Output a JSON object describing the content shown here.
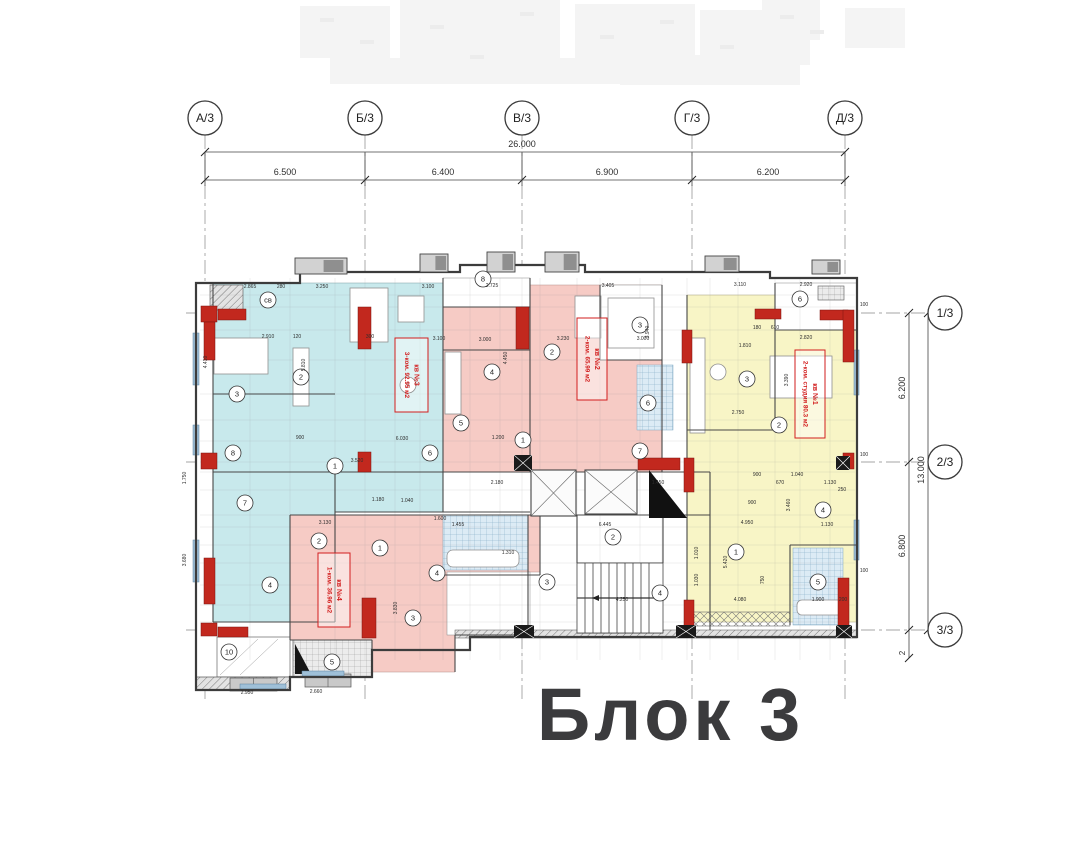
{
  "title": "Блок 3",
  "palette": {
    "cyan": "#c8e9ec",
    "pink": "#f6cbc5",
    "yellow": "#f8f5c6",
    "red_col": "#c2281e",
    "black_col": "#1a1a1a",
    "wall": "#3c3c3c",
    "dim_text": "#2e2e2e",
    "tile_blue": "#dcebf5",
    "tile_line": "#7fa8c4",
    "gray_fill": "#c9c9c9",
    "label_red": "#d21e1e",
    "title_color": "#3b3b3d",
    "window": "#9fc0d8",
    "ghost": "#f1f1f1"
  },
  "axes_top": [
    {
      "label": "А/3",
      "x": 205
    },
    {
      "label": "Б/3",
      "x": 365
    },
    {
      "label": "В/3",
      "x": 522
    },
    {
      "label": "Г/3",
      "x": 692
    },
    {
      "label": "Д/3",
      "x": 845
    }
  ],
  "axes_right": [
    {
      "label": "1/3",
      "y": 313
    },
    {
      "label": "2/3",
      "y": 462
    },
    {
      "label": "3/3",
      "y": 630
    }
  ],
  "dim_top": {
    "total": {
      "text": "26.000",
      "x": 522,
      "y": 147
    },
    "segments_y": 175,
    "segments": [
      {
        "text": "6.500",
        "x": 285
      },
      {
        "text": "6.400",
        "x": 443
      },
      {
        "text": "6.900",
        "x": 607
      },
      {
        "text": "6.200",
        "x": 768
      }
    ]
  },
  "dim_right": {
    "segments": [
      {
        "text": "6.200",
        "x": 905,
        "y": 388
      },
      {
        "text": "6.800",
        "x": 905,
        "y": 546
      }
    ],
    "total": {
      "text": "13.000",
      "x": 924,
      "y": 470
    },
    "extra": {
      "text": "2",
      "x": 905,
      "y": 653
    }
  },
  "apartments": [
    {
      "id": "apt-1",
      "lines": [
        "кв №1",
        "2-ком. студия 80.3 м2"
      ],
      "box": [
        795,
        350,
        30,
        88
      ]
    },
    {
      "id": "apt-2",
      "lines": [
        "кв №2",
        "2-ком. 65.99 м2"
      ],
      "box": [
        577,
        318,
        30,
        82
      ]
    },
    {
      "id": "apt-3",
      "lines": [
        "кв №3",
        "3-ком. 92.95 м2"
      ],
      "box": [
        395,
        338,
        33,
        74
      ]
    },
    {
      "id": "apt-4",
      "lines": [
        "кв №4",
        "1-ком. 36.96 м2"
      ],
      "box": [
        318,
        553,
        32,
        74
      ]
    }
  ],
  "room_circles": [
    {
      "n": "св",
      "x": 268,
      "y": 300
    },
    {
      "n": "2",
      "x": 301,
      "y": 377
    },
    {
      "n": "3",
      "x": 237,
      "y": 394
    },
    {
      "n": "5",
      "x": 408,
      "y": 385
    },
    {
      "n": "8",
      "x": 233,
      "y": 453
    },
    {
      "n": "6",
      "x": 430,
      "y": 453
    },
    {
      "n": "1",
      "x": 335,
      "y": 466
    },
    {
      "n": "7",
      "x": 245,
      "y": 503
    },
    {
      "n": "4",
      "x": 270,
      "y": 585
    },
    {
      "n": "10",
      "x": 229,
      "y": 652
    },
    {
      "n": "5",
      "x": 332,
      "y": 662
    },
    {
      "n": "4",
      "x": 492,
      "y": 372
    },
    {
      "n": "2",
      "x": 552,
      "y": 352
    },
    {
      "n": "3",
      "x": 640,
      "y": 325
    },
    {
      "n": "6",
      "x": 648,
      "y": 403
    },
    {
      "n": "1",
      "x": 523,
      "y": 440
    },
    {
      "n": "5",
      "x": 461,
      "y": 423
    },
    {
      "n": "8",
      "x": 483,
      "y": 279
    },
    {
      "n": "2",
      "x": 319,
      "y": 541
    },
    {
      "n": "1",
      "x": 380,
      "y": 548
    },
    {
      "n": "3",
      "x": 413,
      "y": 618
    },
    {
      "n": "4",
      "x": 437,
      "y": 573
    },
    {
      "n": "3",
      "x": 747,
      "y": 379
    },
    {
      "n": "2",
      "x": 779,
      "y": 425
    },
    {
      "n": "6",
      "x": 800,
      "y": 299
    },
    {
      "n": "1",
      "x": 736,
      "y": 552
    },
    {
      "n": "5",
      "x": 818,
      "y": 582
    },
    {
      "n": "4",
      "x": 823,
      "y": 510
    },
    {
      "n": "2",
      "x": 613,
      "y": 537
    },
    {
      "n": "3",
      "x": 547,
      "y": 582
    },
    {
      "n": "4",
      "x": 660,
      "y": 593
    },
    {
      "n": "7",
      "x": 640,
      "y": 451
    }
  ],
  "dim_labels": [
    [
      "2.865",
      250,
      288,
      0
    ],
    [
      "280",
      281,
      288,
      0
    ],
    [
      "3.250",
      322,
      288,
      0
    ],
    [
      "3.100",
      428,
      288,
      0
    ],
    [
      "2.725",
      492,
      287,
      0
    ],
    [
      "3.405",
      608,
      287,
      0
    ],
    [
      "3.110",
      740,
      286,
      0
    ],
    [
      "2.920",
      806,
      286,
      0
    ],
    [
      "2.910",
      268,
      338,
      0
    ],
    [
      "120",
      297,
      338,
      0
    ],
    [
      "300",
      370,
      338,
      0
    ],
    [
      "3.100",
      439,
      340,
      0
    ],
    [
      "3.000",
      485,
      341,
      0
    ],
    [
      "3.230",
      563,
      340,
      0
    ],
    [
      "3.000",
      643,
      340,
      0
    ],
    [
      "2.820",
      806,
      339,
      0
    ],
    [
      "610",
      775,
      329,
      0
    ],
    [
      "180",
      757,
      329,
      0
    ],
    [
      "1.810",
      745,
      347,
      0
    ],
    [
      "900",
      300,
      439,
      0
    ],
    [
      "6.030",
      402,
      440,
      0
    ],
    [
      "1.200",
      498,
      439,
      0
    ],
    [
      "3.520",
      357,
      462,
      0
    ],
    [
      "2.750",
      738,
      414,
      0
    ],
    [
      "2.180",
      497,
      484,
      0
    ],
    [
      "1.450",
      658,
      484,
      0
    ],
    [
      "1.455",
      458,
      526,
      0
    ],
    [
      "6.445",
      605,
      526,
      0
    ],
    [
      "1.310",
      508,
      554,
      0
    ],
    [
      "3.130",
      325,
      524,
      0
    ],
    [
      "1.180",
      378,
      501,
      0
    ],
    [
      "1.040",
      407,
      502,
      0
    ],
    [
      "1.600",
      440,
      520,
      0
    ],
    [
      "900",
      757,
      476,
      0
    ],
    [
      "1.040",
      797,
      476,
      0
    ],
    [
      "670",
      780,
      484,
      0
    ],
    [
      "1.130",
      830,
      484,
      0
    ],
    [
      "250",
      842,
      491,
      0
    ],
    [
      "900",
      752,
      504,
      0
    ],
    [
      "4.950",
      747,
      524,
      0
    ],
    [
      "1.130",
      827,
      526,
      0
    ],
    [
      "4.080",
      740,
      601,
      0
    ],
    [
      "1.900",
      818,
      601,
      0
    ],
    [
      "200",
      843,
      601,
      0
    ],
    [
      "4.250",
      622,
      601,
      0
    ],
    [
      "2.950",
      247,
      694,
      0
    ],
    [
      "2.660",
      316,
      693,
      0
    ],
    [
      "100",
      864,
      306,
      0
    ],
    [
      "100",
      864,
      456,
      0
    ],
    [
      "100",
      864,
      572,
      0
    ],
    [
      "4.410",
      207,
      362,
      1
    ],
    [
      "5.810",
      305,
      365,
      1
    ],
    [
      "4.450",
      507,
      358,
      1
    ],
    [
      "3.940",
      649,
      332,
      1
    ],
    [
      "3.390",
      788,
      380,
      1
    ],
    [
      "3.460",
      790,
      505,
      1
    ],
    [
      "5.420",
      727,
      562,
      1
    ],
    [
      "1.010",
      698,
      553,
      1
    ],
    [
      "1.030",
      698,
      580,
      1
    ],
    [
      "3.830",
      397,
      608,
      1
    ],
    [
      "3.680",
      186,
      560,
      1
    ],
    [
      "1.750",
      186,
      478,
      1
    ],
    [
      "750",
      764,
      580,
      1
    ]
  ]
}
